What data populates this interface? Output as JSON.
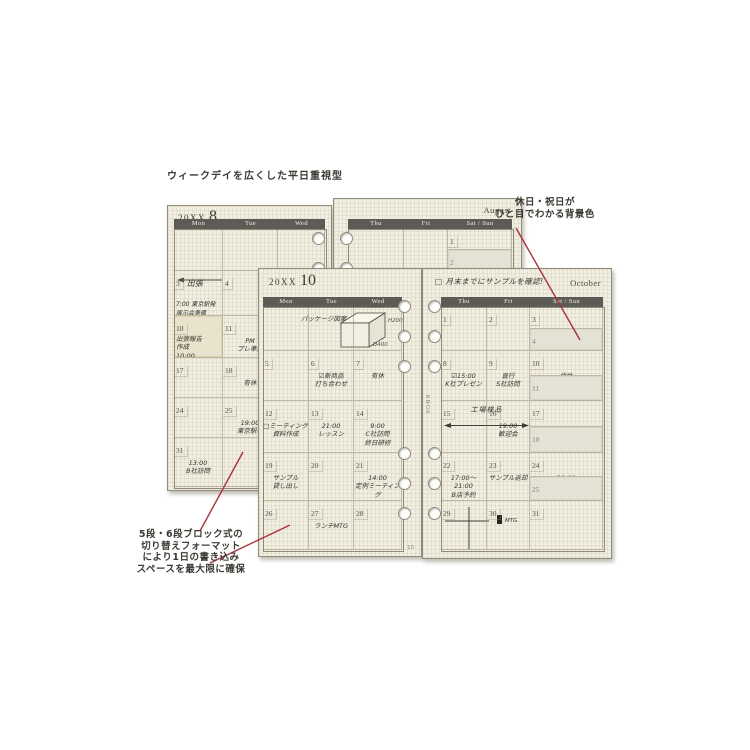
{
  "annotations": {
    "heading": "ウィークデイを広くした平日重視型",
    "holiday_line1": "休日・祝日が",
    "holiday_line2": "ひと目でわかる背景色",
    "bottom_left_lines": [
      "5段・6段ブロック式の",
      "切り替えフォーマット",
      "により1日の書き込み",
      "スペースを最大限に確保"
    ]
  },
  "colors": {
    "page_cream": "#f2efe2",
    "header_band": "#5c5b55",
    "holiday_shade": "#e4e1d5",
    "pointer_red": "#a8323c",
    "ink": "#33322b"
  },
  "august": {
    "title_prefix": "20XX",
    "title_month": "8",
    "month_label": "August",
    "left_headers": [
      "Mon",
      "Tue",
      "Wed"
    ],
    "right_headers": [
      "Thu",
      "Fri",
      "Sat / Sun"
    ],
    "left_rows": [
      [
        {},
        {},
        {}
      ],
      [
        {
          "day": "3",
          "label": "出張",
          "sub": "7:00 東京駅発\n 展示会準備"
        },
        {
          "day": "4"
        },
        {}
      ],
      [
        {
          "day": "10",
          "sticky": true,
          "note": "出張報告\n作成\n10:00\nミーティング"
        },
        {
          "day": "11",
          "note": "PM\nプレ準備"
        },
        {}
      ],
      [
        {
          "day": "17"
        },
        {
          "day": "18",
          "note": "有休"
        },
        {}
      ],
      [
        {
          "day": "24"
        },
        {
          "day": "25",
          "note": "19:00\n東京駅着"
        },
        {}
      ],
      [
        {
          "day": "31",
          "note": "13:00\nB社訪問"
        },
        {},
        {}
      ]
    ],
    "right_rows": [
      [
        {},
        {},
        {
          "day": "1"
        },
        {
          "day": "2",
          "shaded": true,
          "note": "□出張準備"
        }
      ],
      [
        {},
        {},
        {}
      ],
      [
        {},
        {},
        {}
      ],
      [
        {},
        {},
        {}
      ],
      [
        {},
        {},
        {}
      ],
      [
        {},
        {},
        {}
      ]
    ]
  },
  "october": {
    "title_prefix": "20XX",
    "title_month": "10",
    "month_label": "October",
    "memo_checkbox": "□",
    "memo": "月末までにサンプルを確認!",
    "brand": "KNOX",
    "page_number": "10",
    "left_headers": [
      "Mon",
      "Tue",
      "Wed"
    ],
    "right_headers": [
      "Thu",
      "Fri",
      "Sat / Sun"
    ],
    "sketch": {
      "caption": "パッケージ図案",
      "labels": [
        "W250",
        "H200",
        "D400"
      ]
    },
    "span_label": "工場検品",
    "flag_label": "MTG",
    "left_rows": [
      [
        {},
        {},
        {}
      ],
      [
        {
          "day": "5"
        },
        {
          "day": "6",
          "note": "☑新商品\n打ち合わせ"
        },
        {
          "day": "7",
          "note": "有休"
        }
      ],
      [
        {
          "day": "12",
          "note": "□ミーティング\n資料作成"
        },
        {
          "day": "13",
          "note": "21:00\nレッスン"
        },
        {
          "day": "14",
          "note": "9:00\nC社訪問\n終日研修"
        }
      ],
      [
        {
          "day": "19",
          "note": "サンプル\n貸し出し"
        },
        {
          "day": "20"
        },
        {
          "day": "21",
          "note": "14:00\n定例ミーティング"
        }
      ],
      [
        {
          "day": "26"
        },
        {
          "day": "27",
          "note": "ランチMTG"
        },
        {
          "day": "28"
        }
      ]
    ],
    "right_rows": [
      [
        {
          "day": "1"
        },
        {
          "day": "2"
        },
        {
          "day": "3"
        },
        {
          "day": "4",
          "shaded": true
        }
      ],
      [
        {
          "day": "8",
          "note": "☑15:00\nK社プレゼン"
        },
        {
          "day": "9",
          "note": "直行\nS社訪問"
        },
        {
          "day": "10",
          "note": "代休"
        },
        {
          "day": "11",
          "shaded": true
        }
      ],
      [
        {
          "day": "15"
        },
        {
          "day": "16",
          "note": "19:00\n歓迎会"
        },
        {
          "day": "17"
        },
        {
          "day": "18",
          "shaded": true
        }
      ],
      [
        {
          "day": "22",
          "note": "17:00〜\n21:00\nB店予約"
        },
        {
          "day": "23",
          "note": "サンプル返却"
        },
        {
          "day": "24",
          "note": "20:00\n□□□くん会"
        },
        {
          "day": "25",
          "shaded": true
        }
      ],
      [
        {
          "day": "29"
        },
        {
          "day": "30"
        },
        {
          "day": "31"
        }
      ]
    ]
  }
}
